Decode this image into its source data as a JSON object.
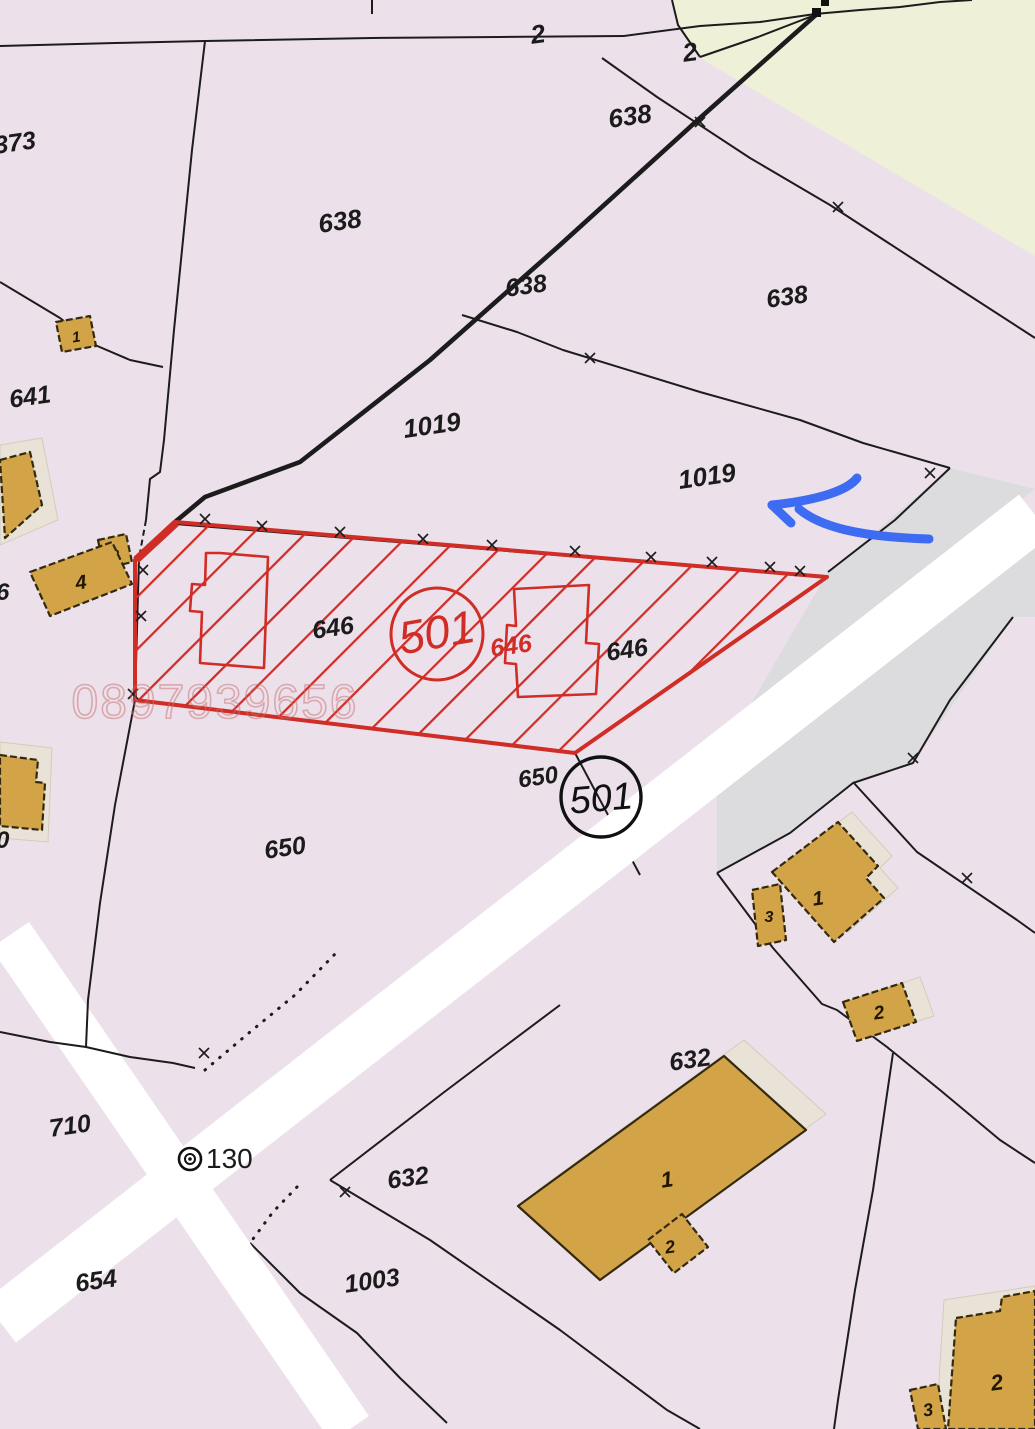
{
  "map": {
    "type": "cadastral-plan",
    "watermark_phone": "0897939656",
    "labels": {
      "p373": "373",
      "p638": "638",
      "p641": "641",
      "p1019": "1019",
      "p646": "646",
      "p650": "650",
      "p710": "710",
      "p654": "654",
      "p1003": "1003",
      "p632": "632",
      "p640": "40",
      "p36": "36",
      "p2": "2",
      "point130": "130",
      "circle501": "501"
    },
    "building_numbers": {
      "n1": "1",
      "n2": "2",
      "n3": "3",
      "n4": "4"
    },
    "colors": {
      "background_pink": "#ece1eb",
      "zone_cream": "#eef0d8",
      "zone_gray": "#dcdcde",
      "road_white": "#ffffff",
      "line_black": "#1c1c1c",
      "building_tan": "#d2a447",
      "building_shadow": "#e8e3d6",
      "red_highlight": "#cf2d26",
      "watermark_pink": "#c86e6e",
      "annotation_blue": "#3d6bf2",
      "label_black": "#1b1b1b"
    }
  }
}
